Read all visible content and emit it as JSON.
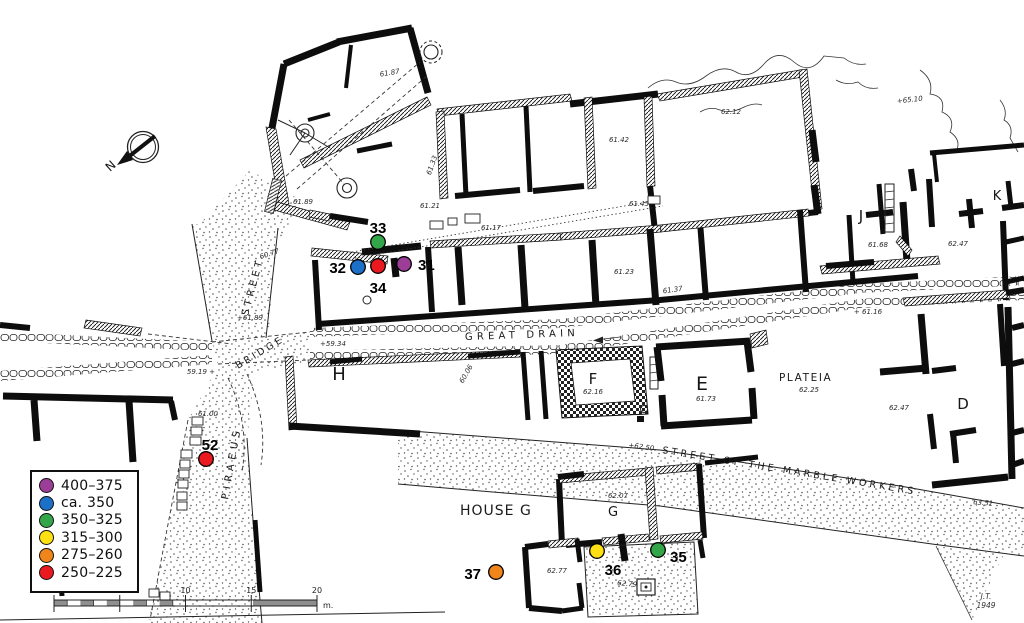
{
  "legend": {
    "items": [
      {
        "label": "400–375",
        "period": "400-375"
      },
      {
        "label": "ca. 350",
        "period": "ca-350"
      },
      {
        "label": "350–325",
        "period": "350-325"
      },
      {
        "label": "315–300",
        "period": "315-300"
      },
      {
        "label": "275–260",
        "period": "275-260"
      },
      {
        "label": "250–225",
        "period": "250-225"
      }
    ]
  },
  "colors": {
    "400-375": "#9C3D97",
    "ca-350": "#1D70C8",
    "350-325": "#33A64A",
    "315-300": "#FFE013",
    "275-260": "#F0861B",
    "250-225": "#E9191F"
  },
  "points": [
    {
      "n": "31",
      "period": "400-375",
      "x": 404,
      "y": 264,
      "lx": 418,
      "ly": 270,
      "anchor": "start"
    },
    {
      "n": "32",
      "period": "ca-350",
      "x": 358,
      "y": 267,
      "lx": 346,
      "ly": 273,
      "anchor": "end"
    },
    {
      "n": "33",
      "period": "350-325",
      "x": 378,
      "y": 242,
      "lx": 378,
      "ly": 233,
      "anchor": "middle"
    },
    {
      "n": "34",
      "period": "250-225",
      "x": 378,
      "y": 266,
      "lx": 378,
      "ly": 293,
      "anchor": "middle"
    },
    {
      "n": "35",
      "period": "350-325",
      "x": 658,
      "y": 550,
      "lx": 670,
      "ly": 562,
      "anchor": "start"
    },
    {
      "n": "36",
      "period": "315-300",
      "x": 597,
      "y": 551,
      "lx": 613,
      "ly": 575,
      "anchor": "middle"
    },
    {
      "n": "37",
      "period": "275-260",
      "x": 496,
      "y": 572,
      "lx": 481,
      "ly": 579,
      "anchor": "end"
    },
    {
      "n": "52",
      "period": "250-225",
      "x": 206,
      "y": 459,
      "lx": 210,
      "ly": 450,
      "anchor": "middle"
    }
  ],
  "streets": {
    "great_drain": "GREAT DRAIN",
    "marble_workers": "STREET OF THE MARBLE WORKERS",
    "piraeus": "PIRAEUS",
    "piraeus_street_word": "STREET",
    "bridge": "BRIDGE",
    "plateia": "PLATEIA",
    "house_g": "HOUSE G"
  },
  "buildings": {
    "h": "H",
    "f": "F",
    "e": "E",
    "g": "G",
    "d": "D",
    "j": "J",
    "k": "K"
  },
  "elevations": [
    {
      "t": "61.87",
      "x": 390,
      "y": 75,
      "r": -9
    },
    {
      "t": "61.89",
      "x": 303,
      "y": 204,
      "r": 0
    },
    {
      "t": "61.33",
      "x": 434,
      "y": 166,
      "r": -70
    },
    {
      "t": "61.21",
      "x": 430,
      "y": 208,
      "r": 0
    },
    {
      "t": "61.17",
      "x": 491,
      "y": 230,
      "r": 0
    },
    {
      "t": "61.45",
      "x": 639,
      "y": 206,
      "r": 0
    },
    {
      "t": "62.12",
      "x": 731,
      "y": 114,
      "r": 0
    },
    {
      "t": "61.42",
      "x": 619,
      "y": 142,
      "r": 0
    },
    {
      "t": "+65.10",
      "x": 910,
      "y": 102,
      "r": -6
    },
    {
      "t": "61.23",
      "x": 624,
      "y": 274,
      "r": 0
    },
    {
      "t": "61.37",
      "x": 673,
      "y": 292,
      "r": -8
    },
    {
      "t": "61.68",
      "x": 878,
      "y": 247,
      "r": 0
    },
    {
      "t": "62.47",
      "x": 958,
      "y": 246,
      "r": 0
    },
    {
      "t": "+ 61.16",
      "x": 868,
      "y": 314,
      "r": 0
    },
    {
      "t": "+59.34",
      "x": 333,
      "y": 346,
      "r": 0
    },
    {
      "t": "59.19 +",
      "x": 201,
      "y": 374,
      "r": 0
    },
    {
      "t": "+61.89",
      "x": 250,
      "y": 320,
      "r": 0
    },
    {
      "t": "60.77",
      "x": 270,
      "y": 256,
      "r": -18
    },
    {
      "t": "61.00",
      "x": 208,
      "y": 416,
      "r": 0
    },
    {
      "t": "60.06",
      "x": 468,
      "y": 375,
      "r": -60
    },
    {
      "t": "62.16",
      "x": 593,
      "y": 394,
      "r": 0
    },
    {
      "t": "61.73",
      "x": 706,
      "y": 401,
      "r": 0
    },
    {
      "t": "62.25",
      "x": 809,
      "y": 392,
      "r": 0
    },
    {
      "t": "62.47",
      "x": 899,
      "y": 410,
      "r": 0
    },
    {
      "t": "+62.50",
      "x": 641,
      "y": 449,
      "r": 8
    },
    {
      "t": "63.51",
      "x": 983,
      "y": 505,
      "r": 5
    },
    {
      "t": "62.07",
      "x": 618,
      "y": 498,
      "r": 0
    },
    {
      "t": "62.77",
      "x": 557,
      "y": 573,
      "r": 0
    },
    {
      "t": "62.79",
      "x": 627,
      "y": 586,
      "r": 5
    }
  ],
  "scale_bar": {
    "ticks": [
      "0",
      "5",
      "10",
      "15",
      "20"
    ],
    "unit": "m."
  },
  "compass": {
    "label": "N"
  },
  "signature": {
    "line1": "J.T.",
    "line2": "1949"
  }
}
